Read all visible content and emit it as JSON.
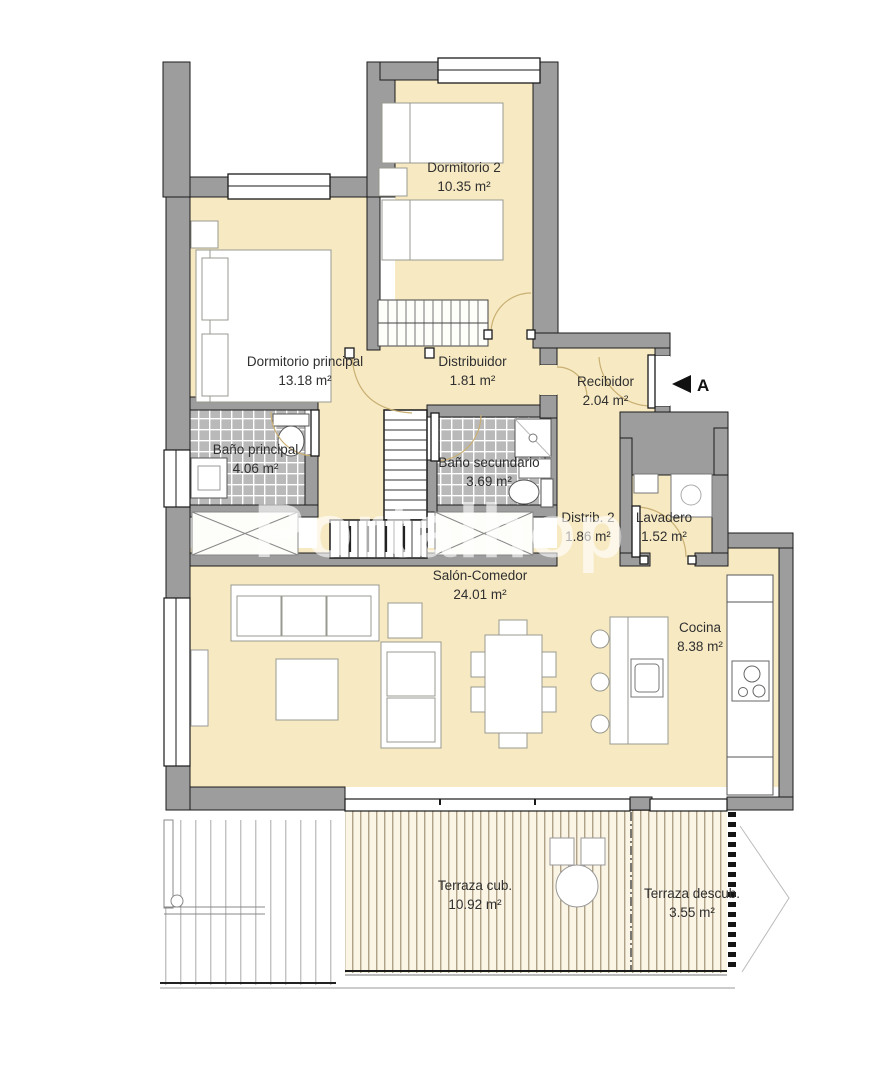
{
  "plan": {
    "title": "Apartment floor plan",
    "watermark": "Portalhop",
    "section_marker": "A",
    "units": "m²",
    "rooms": [
      {
        "name": "Dormitorio 2",
        "area": "10.35 m²"
      },
      {
        "name": "Dormitorio principal",
        "area": "13.18 m²"
      },
      {
        "name": "Distribuidor",
        "area": "1.81 m²"
      },
      {
        "name": "Recibidor",
        "area": "2.04 m²"
      },
      {
        "name": "Baño principal",
        "area": "4.06 m²"
      },
      {
        "name": "Baño secundario",
        "area": "3.69 m²"
      },
      {
        "name": "Distrib. 2",
        "area": "1.86 m²"
      },
      {
        "name": "Lavadero",
        "area": "1.52 m²"
      },
      {
        "name": "Salón-Comedor",
        "area": "24.01 m²"
      },
      {
        "name": "Cocina",
        "area": "8.38 m²"
      },
      {
        "name": "Terraza cub.",
        "area": "10.92 m²"
      },
      {
        "name": "Terraza descub.",
        "area": "3.55 m²"
      }
    ],
    "colors": {
      "floor_cream": "#f7eac3",
      "wall_gray": "#9d9d9d",
      "tile_gray": "#b9b9b9",
      "line_black": "#1a1a1a",
      "terrace_bg": "#fbf5e6",
      "slat_brown": "#8f7f60",
      "furniture_stroke": "#999990",
      "watermark_white": "rgba(255,255,255,0.62)"
    }
  }
}
